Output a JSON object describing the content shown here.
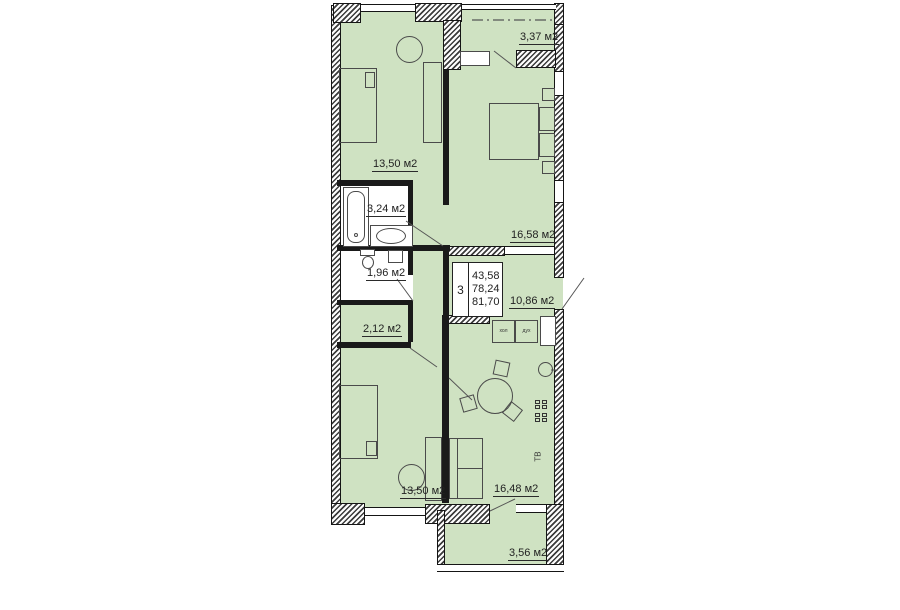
{
  "plan": {
    "colors": {
      "room_fill": "#cfe2c2",
      "wall": "#1a1a1a",
      "background": "#ffffff"
    },
    "info_box": {
      "rooms_count": "3",
      "area_living": "43,58",
      "area_main": "78,24",
      "area_total": "81,70"
    },
    "labels": {
      "bedroom_top_left": "13,50 м2",
      "balcony_top": "3,37 м2",
      "bedroom_top_right": "16,58 м2",
      "bathroom": "3,24 м2",
      "wc": "1,96 м2",
      "corridor": "2,12 м2",
      "hall": "10,86 м2",
      "bedroom_bottom_left": "13,50 м2",
      "living_kitchen": "16,48 м2",
      "balcony_bottom": "3,56 м2"
    },
    "annotations": {
      "tv": "ТВ",
      "fridge": "хол",
      "oven": "дух"
    }
  }
}
